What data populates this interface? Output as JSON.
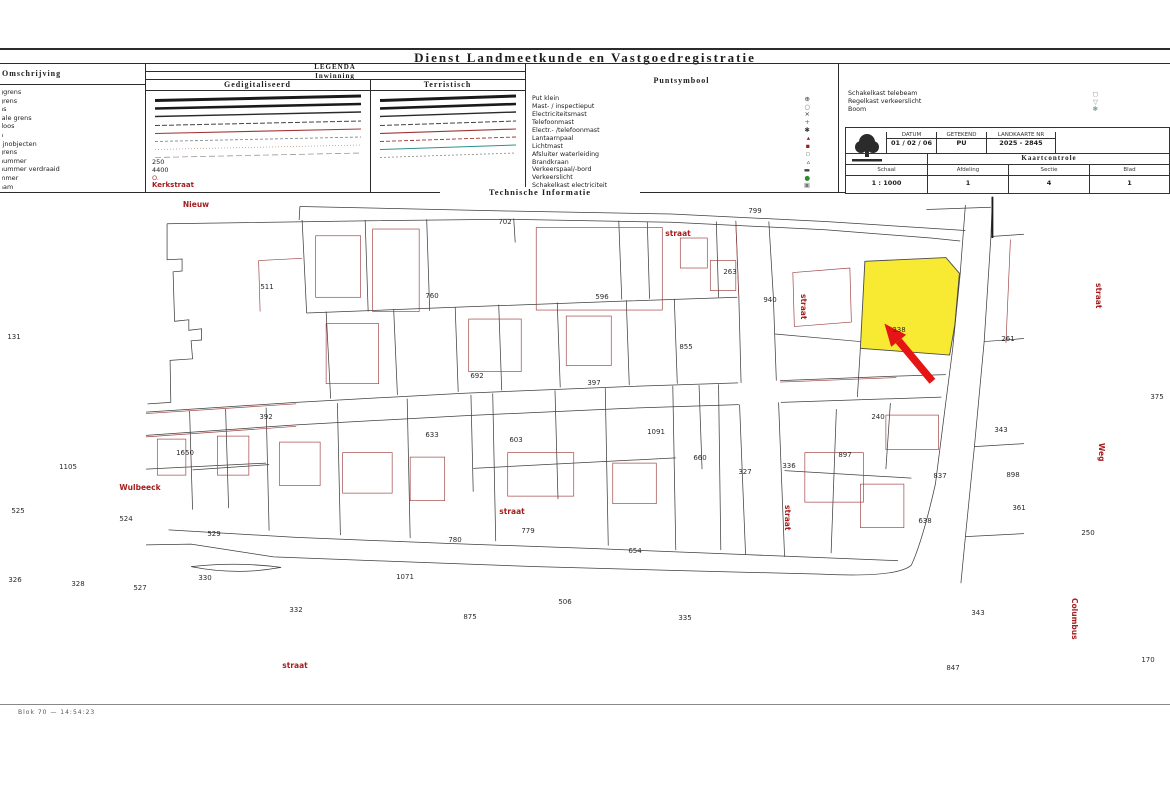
{
  "title": "Dienst Landmeetkunde en Vastgoedregistratie",
  "technische_informatie": "Technische Informatie",
  "legend": {
    "heading": "LEGENDA",
    "omschrijving": {
      "label": "Omschrijving",
      "items": [
        "ggrens",
        "grens",
        "ns",
        "rale grens",
        "doos",
        "n",
        "lijnobjecten",
        "grens",
        "nummer",
        "nummer verdraaid",
        "mmer",
        "aam"
      ]
    },
    "inwinning": {
      "label": "Inwinning",
      "digitized_label": "Gedigitaliseerd",
      "terrestrial_label": "Terristisch",
      "digitized_samples": [
        {
          "c": "#1a1a1a",
          "w": 3
        },
        {
          "c": "#1a1a1a",
          "w": 2.6
        },
        {
          "c": "#2a2a2a",
          "w": 1.4
        },
        {
          "c": "#444444",
          "w": 1,
          "d": "5 2"
        },
        {
          "c": "#a03434",
          "w": 1.1
        },
        {
          "c": "#8a8a8a",
          "w": 0.9,
          "d": "3 2"
        },
        {
          "c": "#bb9988",
          "w": 0.8,
          "d": "1 2"
        },
        {
          "c": "#999999",
          "w": 0.8,
          "d": "6 3"
        }
      ],
      "terrestrial_samples": [
        {
          "c": "#1a1a1a",
          "w": 3
        },
        {
          "c": "#1a1a1a",
          "w": 2.6
        },
        {
          "c": "#2a2a2a",
          "w": 1.4
        },
        {
          "c": "#444444",
          "w": 1,
          "d": "5 2"
        },
        {
          "c": "#a03434",
          "w": 1.1
        },
        {
          "c": "#a03434",
          "w": 0.9,
          "d": "4 2"
        },
        {
          "c": "#2f8f8f",
          "w": 1
        },
        {
          "c": "#888888",
          "w": 0.8,
          "d": "2 2"
        }
      ],
      "scale_numbers": [
        "250",
        "4400"
      ],
      "point_mark": "O.",
      "street_example": "Kerkstraat"
    },
    "puntsymbool": {
      "label": "Puntsymbool",
      "items": [
        {
          "label": "Put klein",
          "symbol": "⊕",
          "color": "#333333"
        },
        {
          "label": "Mast- / inspectieput",
          "symbol": "○",
          "color": "#666666"
        },
        {
          "label": "Electriciteitsmast",
          "symbol": "×",
          "color": "#333333"
        },
        {
          "label": "Telefoonmast",
          "symbol": "+",
          "color": "#2e7d32"
        },
        {
          "label": "Electr.- /telefoonmast",
          "symbol": "✱",
          "color": "#333333"
        },
        {
          "label": "Lantaarnpaal",
          "symbol": "▴",
          "color": "#8b2323"
        },
        {
          "label": "Lichtmast",
          "symbol": "▪",
          "color": "#8b2323"
        },
        {
          "label": "Afsluiter waterleiding",
          "symbol": "▫",
          "color": "#777777"
        },
        {
          "label": "Brandkraan",
          "symbol": "▵",
          "color": "#333333"
        },
        {
          "label": "Verkeerspaal/-bord",
          "symbol": "▬",
          "color": "#444444"
        },
        {
          "label": "Verkeerslicht",
          "symbol": "●",
          "color": "#2e8b2e"
        },
        {
          "label": "Schakelkast electriciteit",
          "symbol": "▣",
          "color": "#777777"
        }
      ]
    },
    "kasten": {
      "items": [
        {
          "label": "Schakelkast telebeam",
          "symbol": "◻",
          "color": "#888888"
        },
        {
          "label": "Regelkast verkeerslicht",
          "symbol": "▽",
          "color": "#888888"
        },
        {
          "label": "Boom",
          "symbol": "❃",
          "color": "#6a9a8a"
        }
      ]
    }
  },
  "titleblock": {
    "datum_label": "DATUM",
    "datum_value": "01 / 02 / 06",
    "getekend_label": "GETEKEND",
    "getekend_value": "PU",
    "landkaart_label": "LANDKAARTE NR",
    "landkaart_value": "2025 - 2845",
    "controle_label": "Kaartcontrole",
    "schaal_label": "Schaal",
    "schaal_value": "1 : 1000",
    "afdeling_label": "Afdeling",
    "afdeling_value": "1",
    "sectie_label": "Sectie",
    "sectie_value": "4",
    "blad_label": "Blad",
    "blad_value": "1"
  },
  "map": {
    "highlight": {
      "parcel_number": "261",
      "fill": "#f8ea33",
      "arrow_color": "#e51515"
    },
    "street_color": "#a51d1d",
    "street_labels": [
      {
        "text": "Nieuw",
        "x": 196,
        "y": 200,
        "v": false
      },
      {
        "text": "straat",
        "x": 678,
        "y": 229,
        "v": false
      },
      {
        "text": "straat",
        "x": 799,
        "y": 294,
        "v": true
      },
      {
        "text": "straat",
        "x": 783,
        "y": 505,
        "v": true
      },
      {
        "text": "Wulbeeck",
        "x": 140,
        "y": 483,
        "v": false
      },
      {
        "text": "straat",
        "x": 512,
        "y": 507,
        "v": false
      },
      {
        "text": "straat",
        "x": 295,
        "y": 661,
        "v": false
      },
      {
        "text": "straat",
        "x": 1094,
        "y": 283,
        "v": true
      },
      {
        "text": "Weg",
        "x": 1097,
        "y": 443,
        "v": true
      },
      {
        "text": "Columbus",
        "x": 1070,
        "y": 598,
        "v": true
      }
    ],
    "parcel_numbers": [
      {
        "n": "702",
        "x": 505,
        "y": 218
      },
      {
        "n": "799",
        "x": 755,
        "y": 207
      },
      {
        "n": "511",
        "x": 267,
        "y": 283
      },
      {
        "n": "760",
        "x": 432,
        "y": 292
      },
      {
        "n": "596",
        "x": 602,
        "y": 293
      },
      {
        "n": "263",
        "x": 730,
        "y": 268
      },
      {
        "n": "940",
        "x": 770,
        "y": 296
      },
      {
        "n": "338",
        "x": 899,
        "y": 326
      },
      {
        "n": "855",
        "x": 686,
        "y": 343
      },
      {
        "n": "131",
        "x": 14,
        "y": 333
      },
      {
        "n": "392",
        "x": 266,
        "y": 413
      },
      {
        "n": "692",
        "x": 477,
        "y": 372
      },
      {
        "n": "397",
        "x": 594,
        "y": 379
      },
      {
        "n": "633",
        "x": 432,
        "y": 431
      },
      {
        "n": "603",
        "x": 516,
        "y": 436
      },
      {
        "n": "1650",
        "x": 185,
        "y": 449
      },
      {
        "n": "1105",
        "x": 68,
        "y": 463
      },
      {
        "n": "1091",
        "x": 656,
        "y": 428
      },
      {
        "n": "240",
        "x": 878,
        "y": 413
      },
      {
        "n": "343",
        "x": 1001,
        "y": 426
      },
      {
        "n": "660",
        "x": 700,
        "y": 454
      },
      {
        "n": "327",
        "x": 745,
        "y": 468
      },
      {
        "n": "336",
        "x": 789,
        "y": 462
      },
      {
        "n": "897",
        "x": 845,
        "y": 451
      },
      {
        "n": "837",
        "x": 940,
        "y": 472
      },
      {
        "n": "898",
        "x": 1013,
        "y": 471
      },
      {
        "n": "361",
        "x": 1019,
        "y": 504
      },
      {
        "n": "250",
        "x": 1088,
        "y": 529
      },
      {
        "n": "525",
        "x": 18,
        "y": 507
      },
      {
        "n": "524",
        "x": 126,
        "y": 515
      },
      {
        "n": "529",
        "x": 214,
        "y": 530
      },
      {
        "n": "326",
        "x": 15,
        "y": 576
      },
      {
        "n": "328",
        "x": 78,
        "y": 580
      },
      {
        "n": "527",
        "x": 140,
        "y": 584
      },
      {
        "n": "330",
        "x": 205,
        "y": 574
      },
      {
        "n": "332",
        "x": 296,
        "y": 606
      },
      {
        "n": "780",
        "x": 455,
        "y": 536
      },
      {
        "n": "779",
        "x": 528,
        "y": 527
      },
      {
        "n": "1071",
        "x": 405,
        "y": 573
      },
      {
        "n": "875",
        "x": 470,
        "y": 613
      },
      {
        "n": "506",
        "x": 565,
        "y": 598
      },
      {
        "n": "654",
        "x": 635,
        "y": 547
      },
      {
        "n": "335",
        "x": 685,
        "y": 614
      },
      {
        "n": "638",
        "x": 925,
        "y": 517
      },
      {
        "n": "343",
        "x": 978,
        "y": 609
      },
      {
        "n": "847",
        "x": 953,
        "y": 664
      },
      {
        "n": "170",
        "x": 1148,
        "y": 656
      },
      {
        "n": "375",
        "x": 1157,
        "y": 393
      },
      {
        "n": "261",
        "x": 1008,
        "y": 335
      }
    ],
    "footer": "Blok 70 — 14:54:23"
  }
}
